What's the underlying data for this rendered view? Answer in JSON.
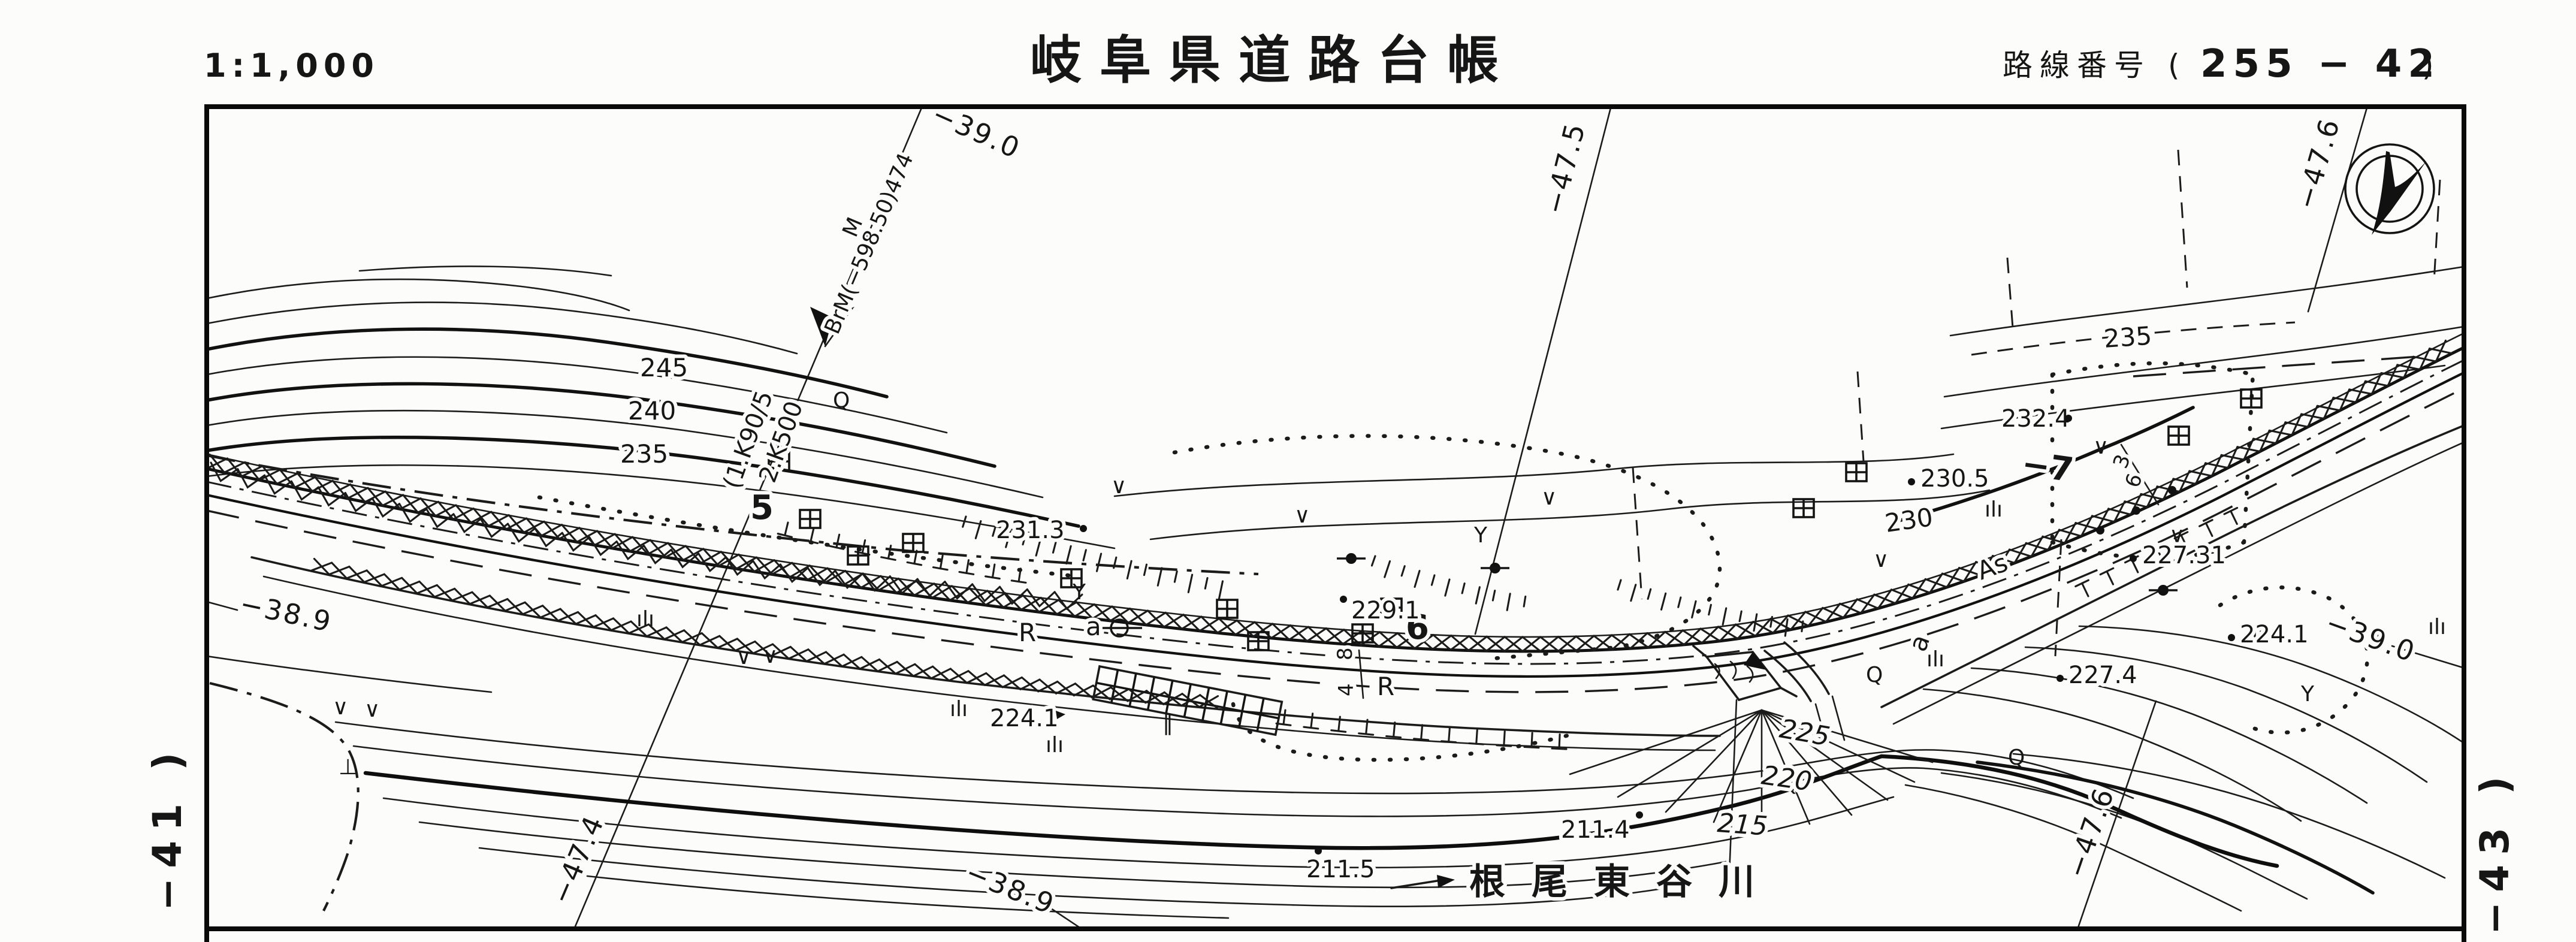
{
  "header": {
    "scale": "1:1,000",
    "title": "岐阜県道路台帳",
    "route_label": "路線番号",
    "route_open": "(",
    "route_number": "255 − 42",
    "route_close": ")"
  },
  "margins": {
    "left": "−41 )",
    "right": "−43 )"
  },
  "grid": {
    "top_y": "−39.0",
    "top_x1": "−47.5",
    "top_x2": "−47.6",
    "left_y": "−38.9",
    "right_y": "−39.0",
    "bottom_x1": "−47.4",
    "bottom_y": "−38.9",
    "bottom_x2": "−47.6"
  },
  "benchmark": {
    "sup": "M",
    "text": "BrM(−598.50)474",
    "aux1": "(1.K90/5",
    "aux2": "2.K500"
  },
  "stations": {
    "s5": "5",
    "s6": "6",
    "s7": "−7"
  },
  "road": {
    "r1": "R",
    "a1": "a",
    "r2": "R",
    "a2": "a",
    "surface": "As",
    "dim1": "8",
    "dim2": "4",
    "dim3": "3",
    "dim4": "6"
  },
  "contours": {
    "c245": "245",
    "c240": "240",
    "c235": "235",
    "c230": "230",
    "c235r": "235",
    "c225": "225",
    "c220": "220",
    "c215": "215"
  },
  "spots": {
    "e231_3": "231.3",
    "e229_1": "229.1",
    "e232_4": "232.4",
    "e230_5": "230.5",
    "e227_31": "227.31",
    "e227_4": "227.4",
    "e224_1r": "224.1",
    "e224_1l": "224.1",
    "e211_5": "211.5",
    "e211_4": "211.4"
  },
  "river": {
    "name": "根尾東谷川"
  },
  "symbols": {
    "v": "∨",
    "y": "Y",
    "q": "Q",
    "grass": "ılı",
    "paddy": "‖",
    "tee": "⊥"
  }
}
